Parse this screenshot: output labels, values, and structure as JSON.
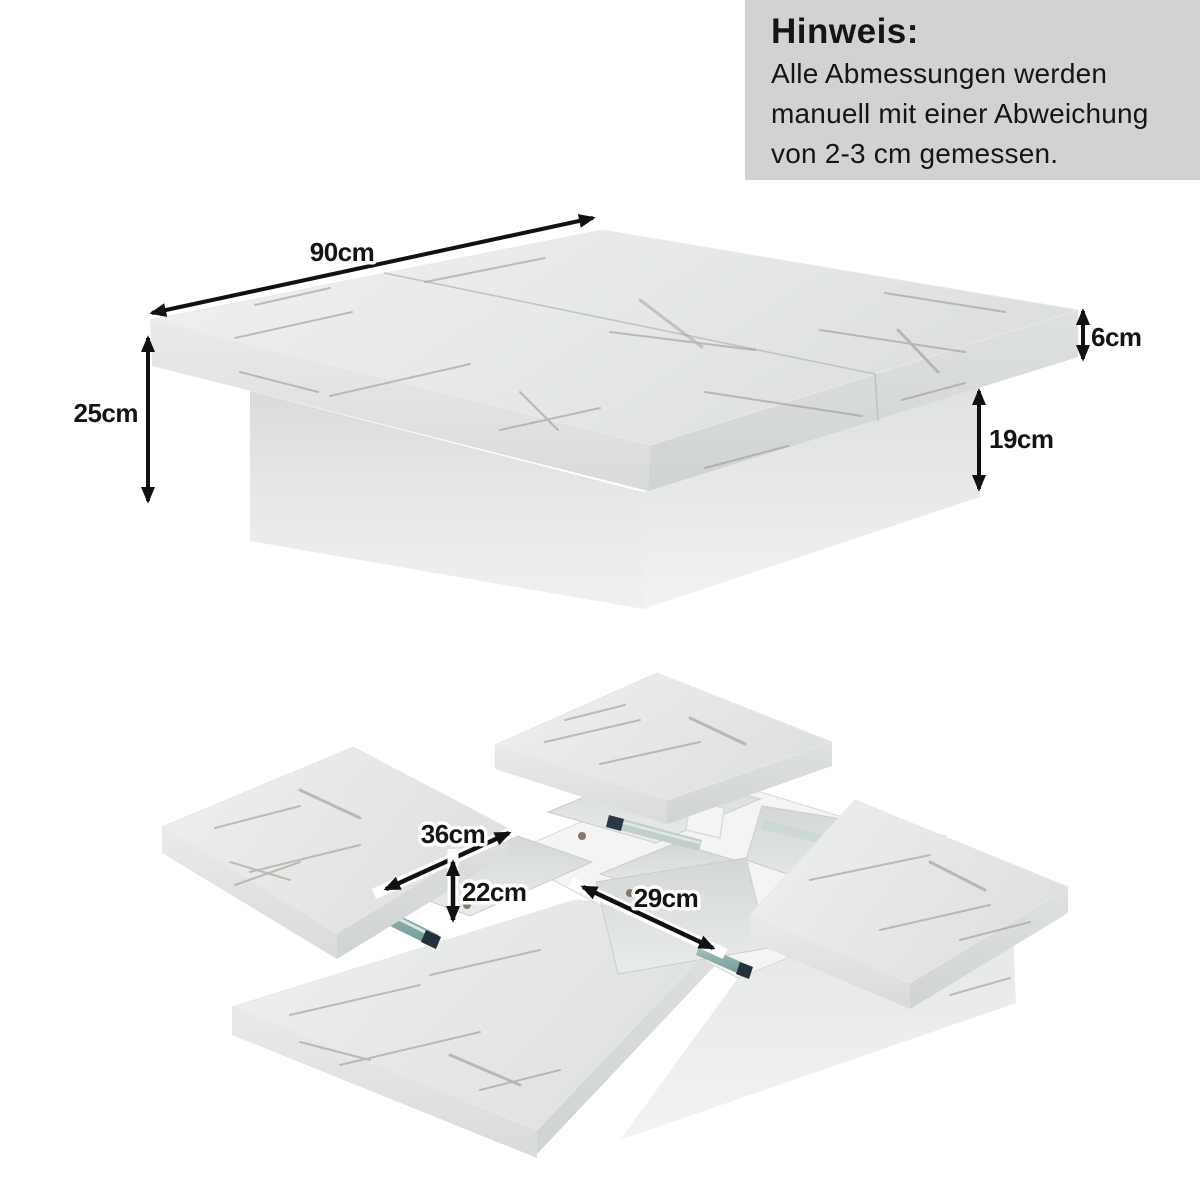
{
  "note": {
    "title": "Hinweis:",
    "line1": "Alle Abmessungen werden",
    "line2": "manuell mit einer Abweichung",
    "line3": "von 2-3 cm gemessen."
  },
  "assembled_view": {
    "top_width": "90cm",
    "total_height": "25cm",
    "top_thickness": "6cm",
    "base_height": "19cm"
  },
  "extended_view": {
    "panel_extension": "36cm",
    "compartment_height": "22cm",
    "compartment_length": "29cm"
  },
  "colors": {
    "background": "#ffffff",
    "note_bg": "#d2d2d2",
    "text": "#151515",
    "arrow": "#111111",
    "marble_light": "#f0f1f0",
    "marble_shade": "#d9dcdb",
    "vein": "#a09a8e",
    "slide_teal": "#76a09a",
    "slide_steel": "#c6d2d0",
    "slide_clip": "#22313b"
  }
}
